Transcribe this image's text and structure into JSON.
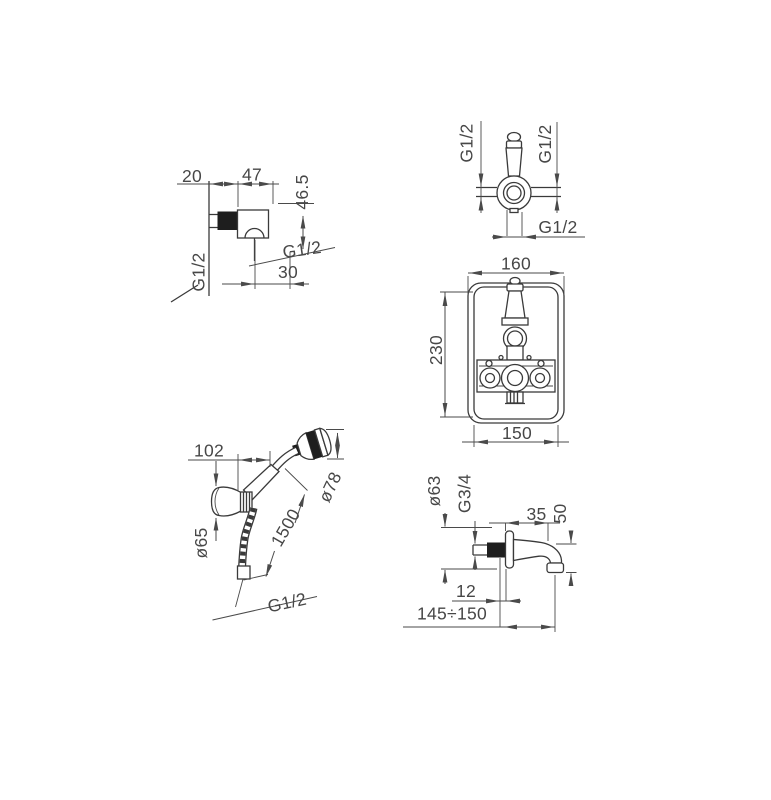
{
  "drawing": {
    "kind": "technical-dimension-drawing",
    "figures": {
      "wall_elbow": {
        "labels": {
          "dim_20": "20",
          "dim_47": "47",
          "dim_46_5": "46.5",
          "thread_outlet": "G1/2",
          "dim_30": "30",
          "thread_inlet": "G1/2"
        }
      },
      "valve_top_view": {
        "labels": {
          "thread_left": "G1/2",
          "thread_right": "G1/2",
          "thread_bottom": "G1/2"
        }
      },
      "valve_front_view": {
        "labels": {
          "dim_width_top": "160",
          "dim_height": "230",
          "dim_width_bottom": "150"
        }
      },
      "hand_shower": {
        "labels": {
          "dim_offset": "102",
          "dim_head_diameter": "ø78",
          "dim_bracket_diameter": "ø65",
          "dim_hose_length": "1500",
          "thread": "G1/2"
        }
      },
      "spout": {
        "labels": {
          "dim_flange_diameter": "ø63",
          "thread": "G3/4",
          "dim_projection": "35",
          "dim_drop": "50",
          "dim_wall_offset": "12",
          "dim_reach": "145÷150"
        }
      }
    },
    "colors": {
      "line": "#3a3a3a",
      "dim_line": "#4a4a4a",
      "text": "#474747",
      "solid_fill": "#1e1e1e",
      "background": "#ffffff"
    }
  }
}
